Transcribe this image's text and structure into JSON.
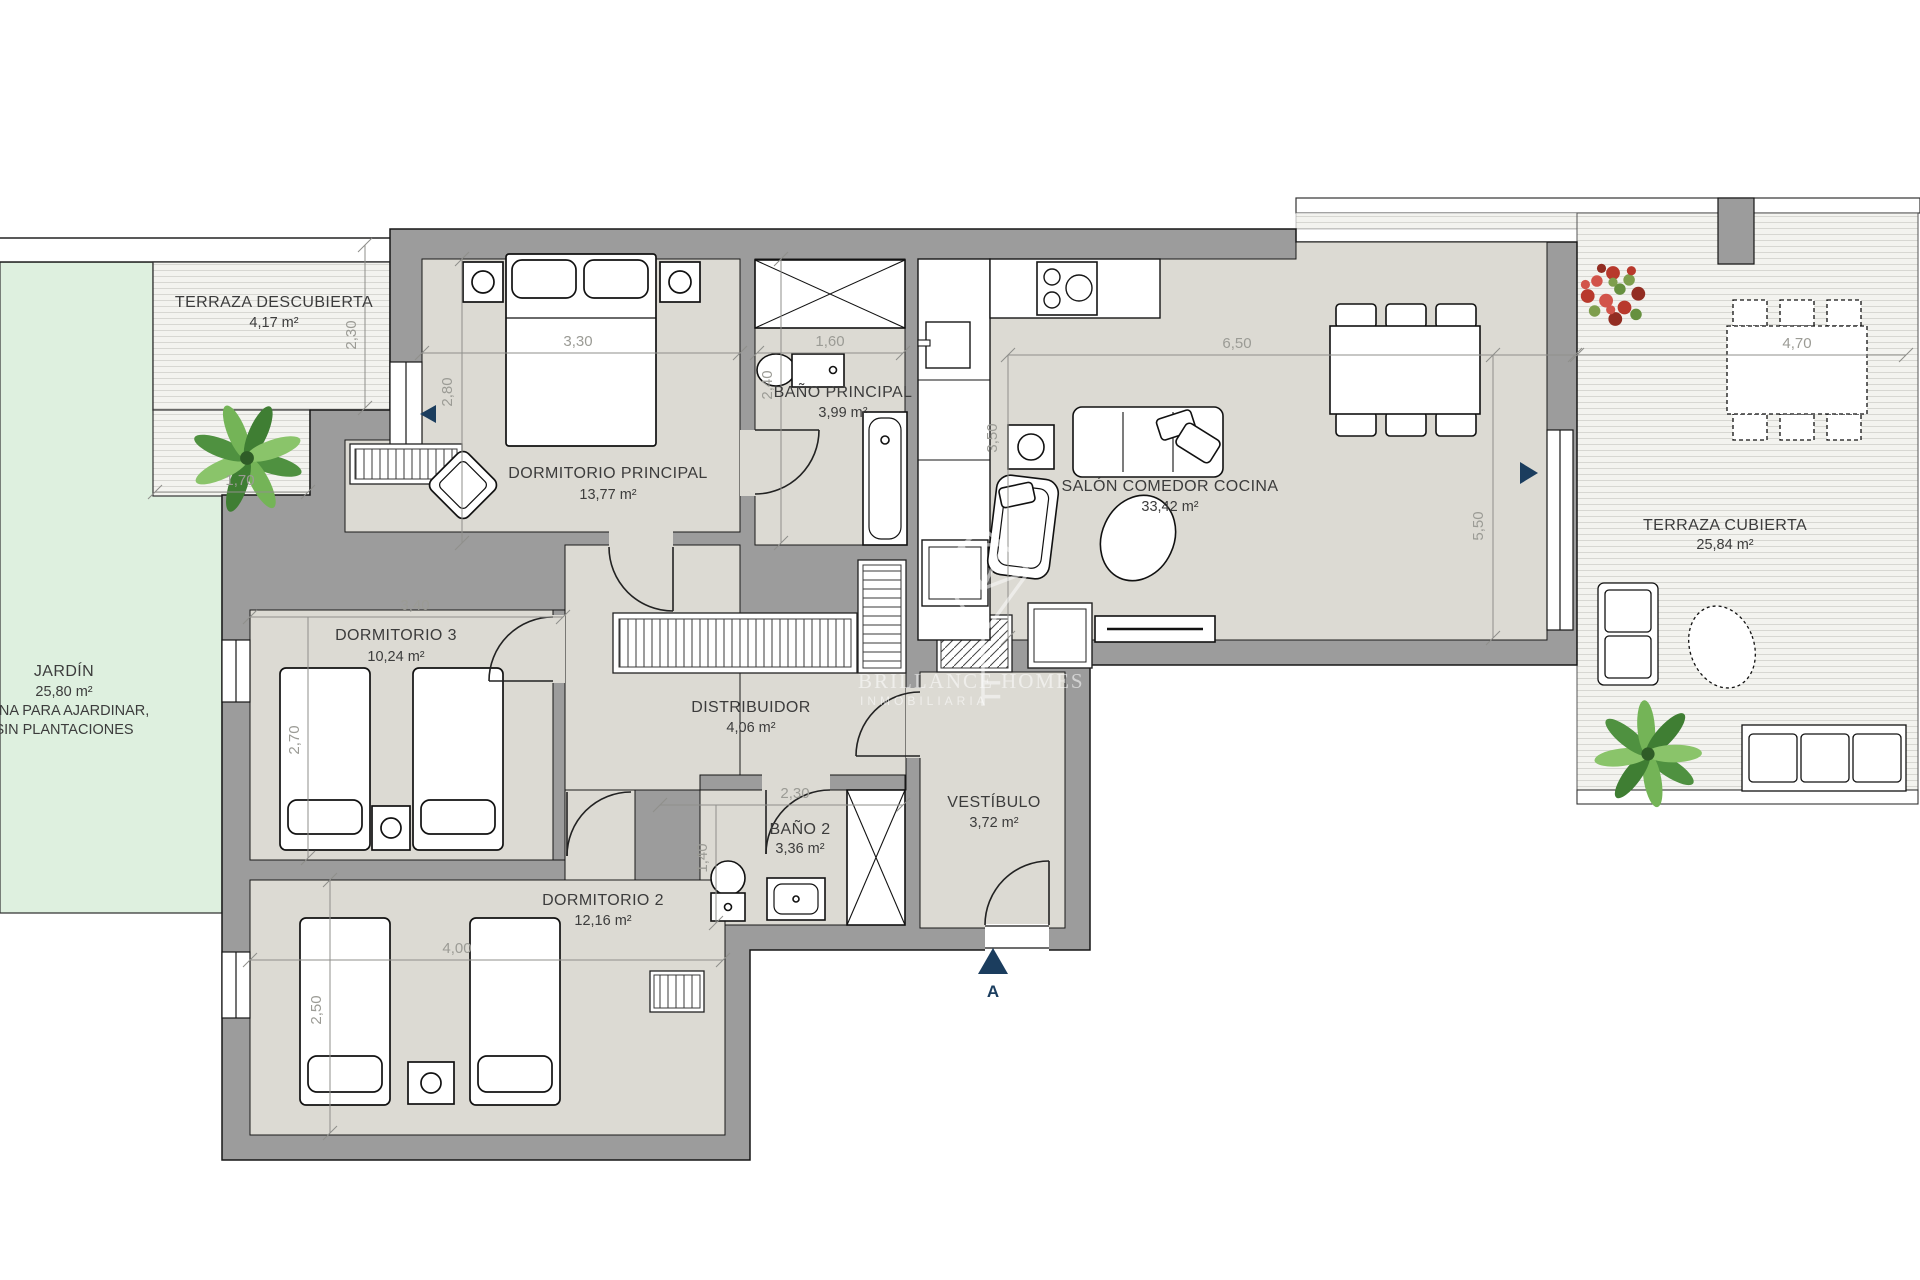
{
  "meta": {
    "type": "floor-plan",
    "canvas": {
      "width": 1920,
      "height": 1280
    }
  },
  "colors": {
    "wall": "#9c9c9c",
    "floor": "#dcdad3",
    "garden": "#def0df",
    "terrace_stripe": "#d7d7d2",
    "accent_navy": "#1b3d5e",
    "dimension_text": "#9b9b95",
    "label_text": "#3c3c3c",
    "background": "#ffffff"
  },
  "rooms": [
    {
      "id": "terraza-descubierta",
      "name": "TERRAZA DESCUBIERTA",
      "area": "4,17 m²"
    },
    {
      "id": "jardin",
      "name": "JARDÍN",
      "area": "25,80 m²",
      "note_line1": "ZONA PARA AJARDINAR,",
      "note_line2": "SIN PLANTACIONES"
    },
    {
      "id": "dormitorio-principal",
      "name": "DORMITORIO PRINCIPAL",
      "area": "13,77 m²"
    },
    {
      "id": "bano-principal",
      "name": "BAÑO PRINCIPAL",
      "area": "3,99 m²"
    },
    {
      "id": "salon-comedor-cocina",
      "name": "SALÓN COMEDOR COCINA",
      "area": "33,42 m²"
    },
    {
      "id": "dormitorio-3",
      "name": "DORMITORIO 3",
      "area": "10,24 m²"
    },
    {
      "id": "distribuidor",
      "name": "DISTRIBUIDOR",
      "area": "4,06 m²"
    },
    {
      "id": "bano-2",
      "name": "BAÑO 2",
      "area": "3,36 m²"
    },
    {
      "id": "dormitorio-2",
      "name": "DORMITORIO 2",
      "area": "12,16 m²"
    },
    {
      "id": "vestibulo",
      "name": "VESTÍBULO",
      "area": "3,72 m²"
    },
    {
      "id": "terraza-cubierta",
      "name": "TERRAZA CUBIERTA",
      "area": "25,84 m²"
    }
  ],
  "dims": [
    "2,30",
    "1,70",
    "3,30",
    "2,80",
    "1,60",
    "2,40",
    "6,50",
    "3,50",
    "5,50",
    "4,70",
    "3,40",
    "2,70",
    "2,30",
    "1,40",
    "4,00",
    "2,50"
  ],
  "watermark": {
    "line1": "BRILLANCE HOMES",
    "line2": "INMOBILIARIA"
  },
  "section_marker": {
    "label": "A"
  }
}
